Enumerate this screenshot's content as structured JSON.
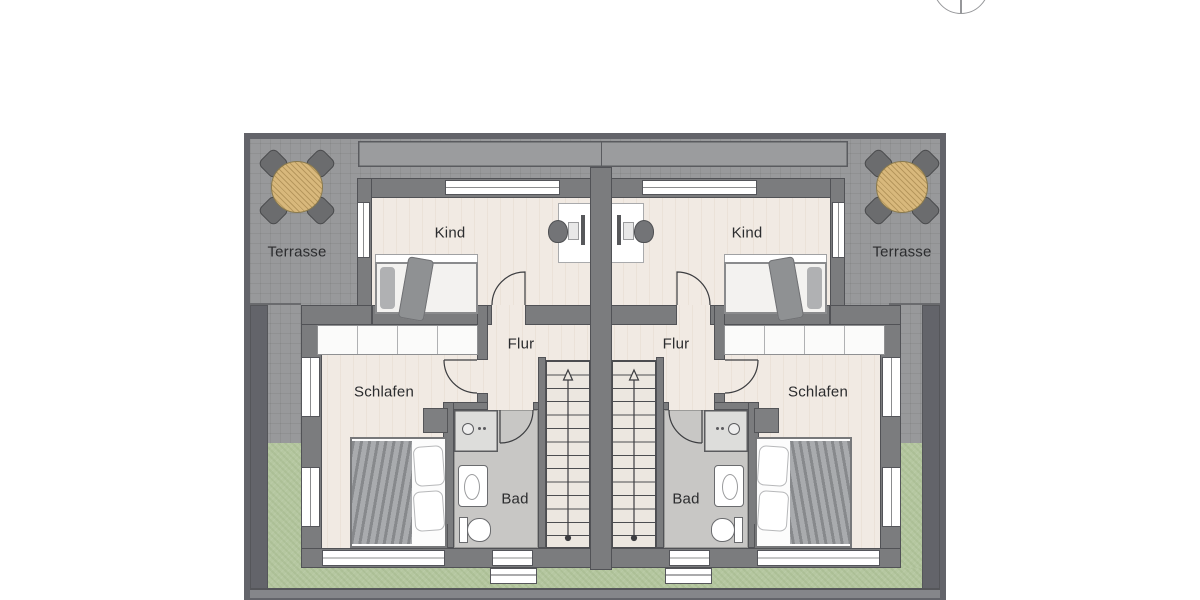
{
  "plan": {
    "type": "residential floor plan, mirrored semi-detached house (upper floor)",
    "units": 2
  },
  "labels": {
    "terrasse_left": "Terrasse",
    "terrasse_right": "Terrasse",
    "kind_left": "Kind",
    "kind_right": "Kind",
    "flur_left": "Flur",
    "flur_right": "Flur",
    "schlafen_left": "Schlafen",
    "schlafen_right": "Schlafen",
    "bad_left": "Bad",
    "bad_right": "Bad"
  },
  "rooms_per_unit": [
    "Kind",
    "Flur",
    "Schlafen",
    "Bad",
    "Terrasse"
  ],
  "stairs": {
    "direction": "up",
    "treads": 14
  },
  "compass": {
    "icon": "north-indicator-icon"
  },
  "furniture_icons": [
    "terrace-table-icon",
    "terrace-chair-icon",
    "child-bed-icon",
    "desk-icon",
    "desk-chair-icon",
    "monitor-icon",
    "wardrobe-icon",
    "double-bed-icon",
    "nightstand-icon",
    "shower-icon",
    "sink-icon",
    "toilet-icon",
    "stairs-icon"
  ],
  "colors": {
    "background": "#ffffff",
    "terrace_gray": "#98999b",
    "boundary_wall": "#63646a",
    "building_wall": "#7b7c7e",
    "interior_floor": "#f1eae3",
    "bathroom_floor": "#c8c7c5",
    "grass_green": "#b5c7a0",
    "table_wood": "#d8b87c",
    "label_ink": "#2b2c2e"
  }
}
